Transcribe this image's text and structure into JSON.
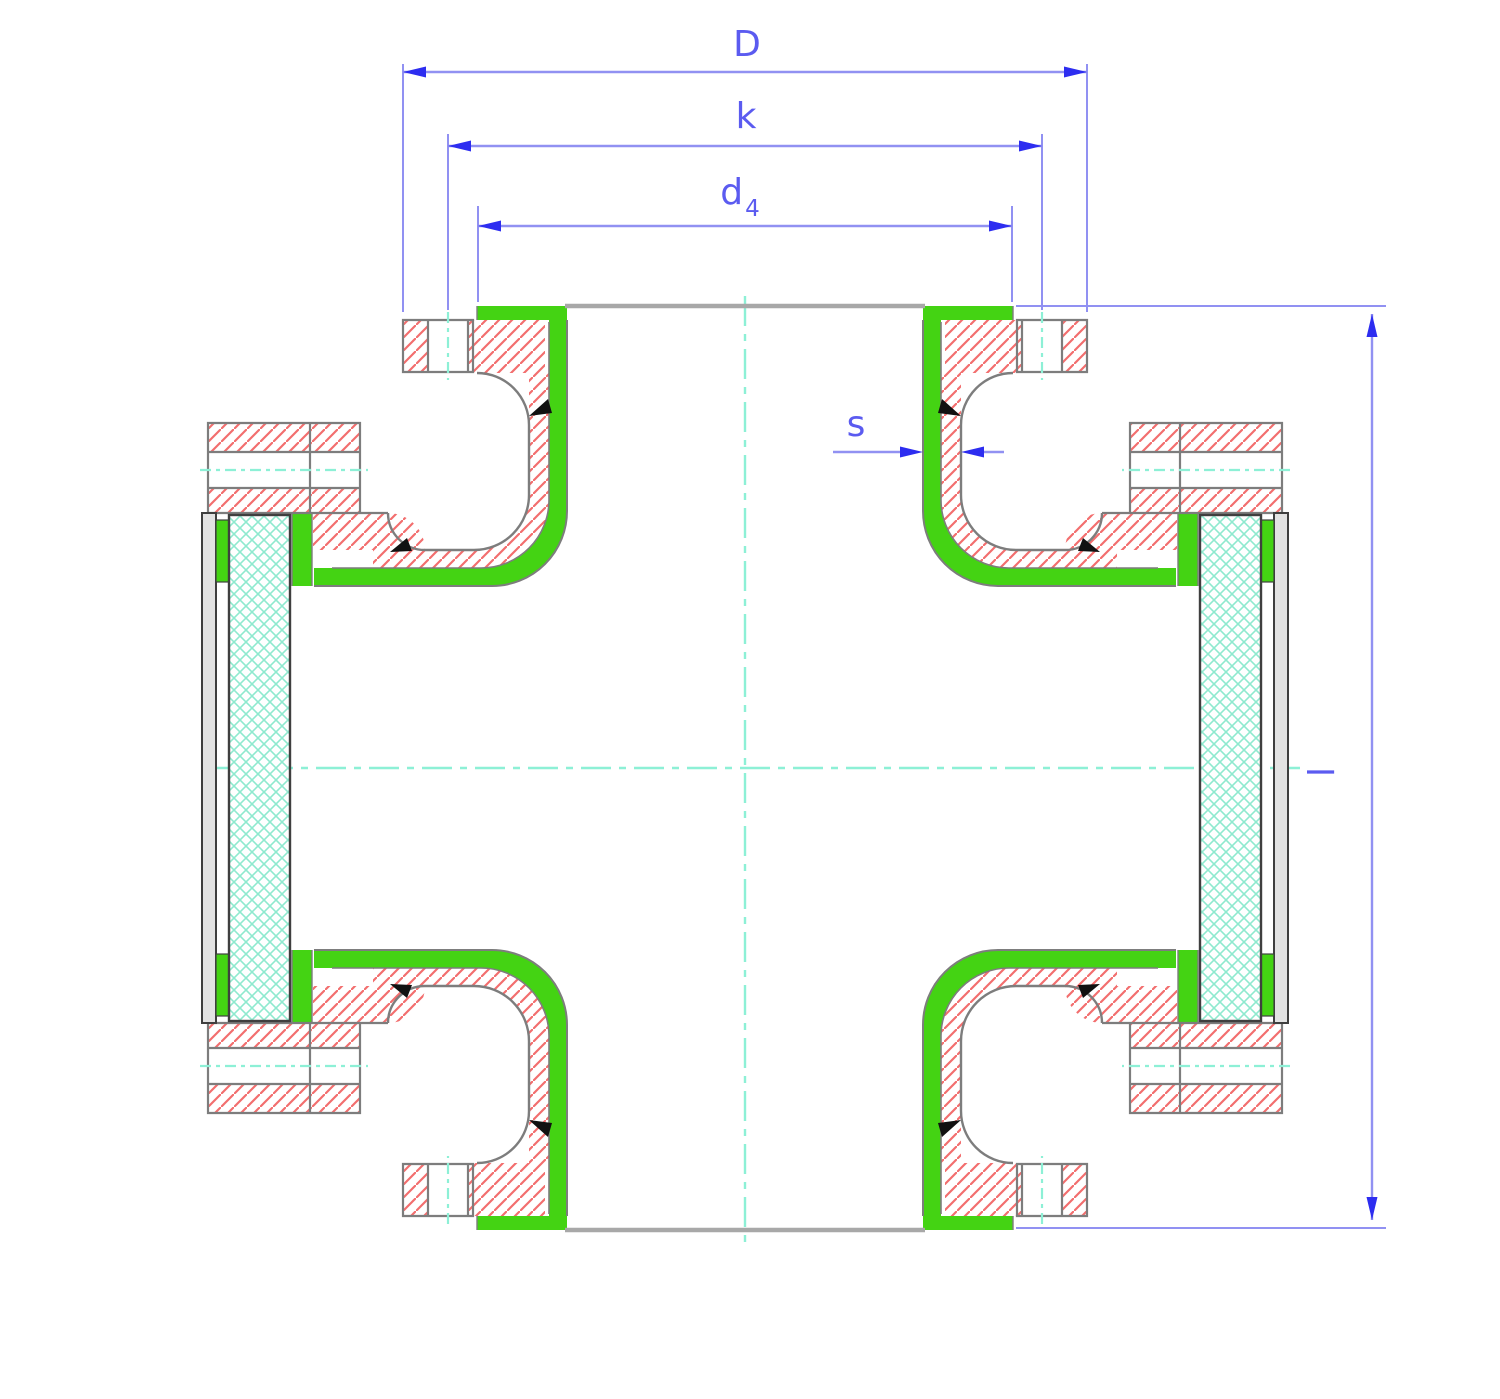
{
  "drawing": {
    "title": "flanged-cross-fitting-cross-section",
    "type": "technical-section-drawing",
    "dimensions": {
      "D": {
        "label": "D",
        "meaning": "flange-outside-diameter"
      },
      "k": {
        "label": "k",
        "meaning": "bolt-circle-diameter"
      },
      "d4": {
        "label": "d",
        "subscript": "4",
        "meaning": "sealing-face-diameter"
      },
      "s": {
        "label": "s",
        "meaning": "wall-thickness"
      },
      "l": {
        "label": "l",
        "meaning": "face-to-face-length"
      }
    },
    "colors": {
      "background": "#ffffff",
      "lining_green": "#44d313",
      "steel_hatch_red": "#f26e6e",
      "outline_grey": "#7d7d7d",
      "face_line_grey": "#a8a8a8",
      "cover_dark": "#3f3f3f",
      "backing_grey": "#e3e3e3",
      "centerline_mint": "#8df0d6",
      "crosshatch_mint": "#8fe9cf",
      "dimension_blue": "#9191f2",
      "arrow_blue": "#2d2df0",
      "label_blue": "#5b5bf0",
      "marker_black": "#111111"
    }
  }
}
